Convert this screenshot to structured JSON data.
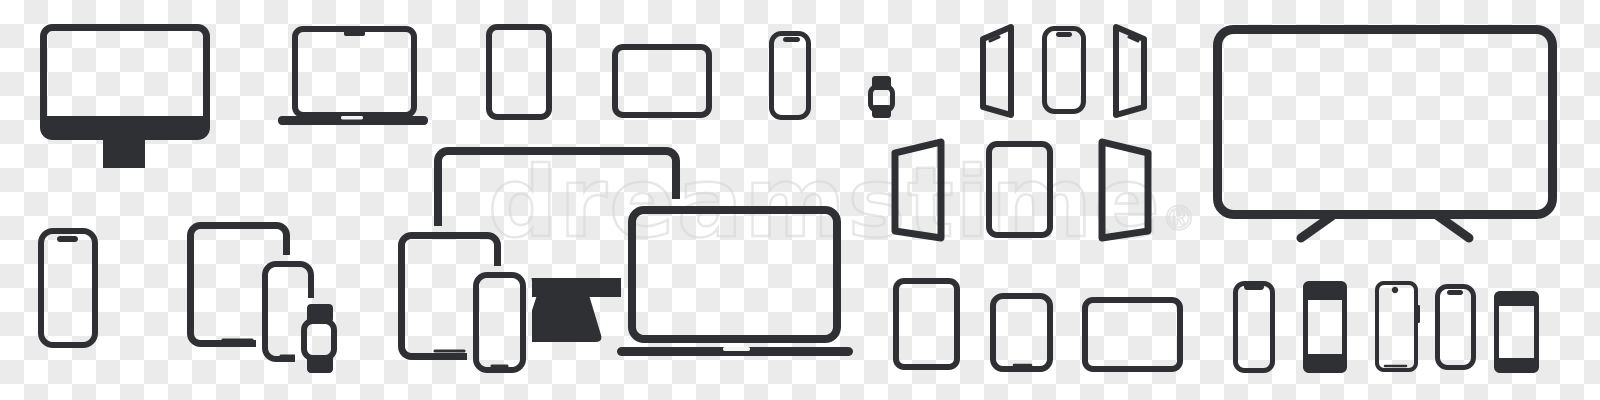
{
  "canvas": {
    "width": 1600,
    "height": 400,
    "checker_light": "#ffffff",
    "checker_dark": "#ebebeb",
    "checker_size_px": 24,
    "icon_color": "#2e3033",
    "watermark_color": "#d9d9d9"
  },
  "watermark": {
    "text": "dreamstime",
    "registered": "®"
  },
  "icons": [
    {
      "label": "Desktop monitor"
    },
    {
      "label": "Laptop with notch"
    },
    {
      "label": "Tablet portrait"
    },
    {
      "label": "Tablet landscape"
    },
    {
      "label": "Smartphone with pill camera"
    },
    {
      "label": "Smartwatch"
    },
    {
      "label": "Smartphone angled left"
    },
    {
      "label": "Smartphone front"
    },
    {
      "label": "Smartphone angled right"
    },
    {
      "label": "Smart TV"
    },
    {
      "label": "Smartphone with pill camera"
    },
    {
      "label": "Tablet, phone and smartwatch group"
    },
    {
      "label": "Monitor, tablet, phone and laptop group"
    },
    {
      "label": "Tablet angled left"
    },
    {
      "label": "Tablet front"
    },
    {
      "label": "Tablet angled right"
    },
    {
      "label": "Tablet portrait"
    },
    {
      "label": "Small tablet with home line"
    },
    {
      "label": "Tablet landscape"
    },
    {
      "label": "Phone with notch"
    },
    {
      "label": "Phone with solid bezels"
    },
    {
      "label": "Phone with punch-hole camera"
    },
    {
      "label": "Phone with pill camera"
    },
    {
      "label": "Phone with dark bezel bands"
    }
  ]
}
